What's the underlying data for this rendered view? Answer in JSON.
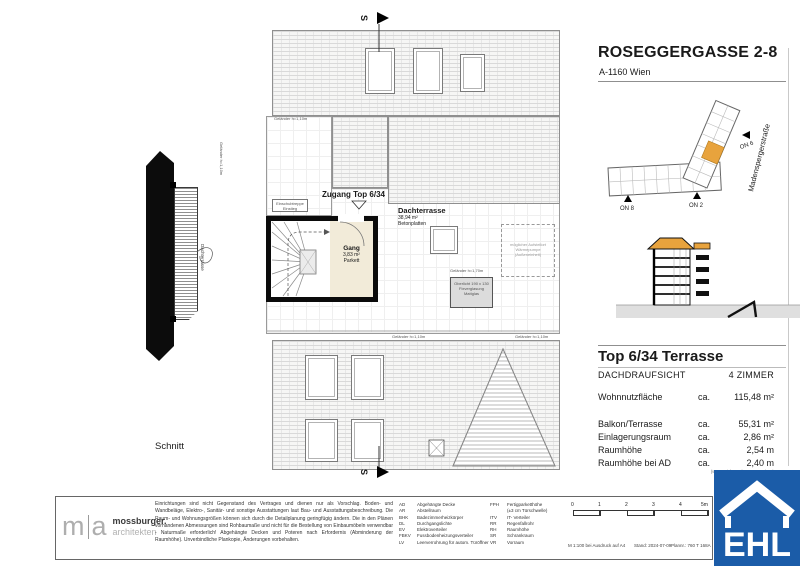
{
  "colors": {
    "accent_orange": "#E8A33D",
    "brand_blue": "#1B5CA8",
    "floor_beige": "#F2EBD9"
  },
  "header": {
    "project": "ROSEGGERGASSE 2-8",
    "address": "A-1160 Wien"
  },
  "site_plan": {
    "street": "Madenspergerstraße",
    "entrance_left": "ON 8",
    "entrance_mid": "ON 2",
    "entrance_right": "ON 6"
  },
  "unit": {
    "title": "Top 6/34 Terrasse",
    "view": "DACHDRAUFSICHT",
    "rooms": "4 ZIMMER"
  },
  "areas": {
    "rows": [
      {
        "label": "Wohnnutzfläche",
        "prefix": "ca.",
        "value": "115,48 m²"
      },
      {
        "label": "Balkon/Terrasse",
        "prefix": "ca.",
        "value": "55,31 m²"
      },
      {
        "label": "Einlagerungsraum",
        "prefix": "ca.",
        "value": "2,86 m²"
      },
      {
        "label": "Raumhöhe",
        "prefix": "ca.",
        "value": "2,54 m"
      },
      {
        "label": "Raumhöhe bei AD",
        "prefix": "ca.",
        "value": "2,40 m"
      }
    ],
    "note": "(wenn nicht anders angegeben)"
  },
  "plan": {
    "section_letter": "S",
    "zugang": "Zugang Top 6/34",
    "terrace_name": "Dachterrasse",
    "terrace_area": "38,94 m²",
    "terrace_floor": "Betonplatten",
    "gang_name": "Gang",
    "gang_area": "3,83 m²",
    "gang_floor": "Parkett",
    "railing": "Geländer h=1,10m",
    "railing_tall": "Geländer h=1,70m",
    "oberlicht_1": "Oberlicht 190 x 130",
    "oberlicht_2": "Fixverglasung",
    "oberlicht_3": "Mattglas",
    "heatpump_1": "möglicher Aufstellort",
    "heatpump_2": "Wärmepumpe (Außeneinheit)",
    "hatch_1": "Einschubtreppe",
    "hatch_2": "Einstieg",
    "section_label": "Dachterrasse",
    "schnitt": "Schnitt"
  },
  "footer": {
    "architect": {
      "mark_m": "m",
      "mark_a": "a",
      "name": "mossburger.",
      "profession": "architekten"
    },
    "disclaimer": "Einrichtungen sind nicht Gegenstand des Vertrages und dienen nur als Vorschlag. Boden- und Wandbeläge, Elektro-, Sanitär- und sonstige Ausstattungen laut Bau- und Ausstattungsbeschreibung. Die Raum- und Wohnungsgrößen können sich durch die Detailplanung geringfügig ändern. Die in den Plänen vorhandenen Abmessungen sind Rohbaumaße und nicht für die Bestellung von Einbaumöbeln verwendbar - Naturmaße erforderlich! Abgehängte Decken und Poteren nach Erfordernis (Abminderung der Raumhöhe). Unverbindliche Plankopie, Änderungen vorbehalten.",
    "legend1": [
      {
        "abbr": "AD",
        "term": "Abgehängte Decke"
      },
      {
        "abbr": "AR",
        "term": "Abstellraum"
      },
      {
        "abbr": "BHK",
        "term": "Badezimmerheizkörper"
      },
      {
        "abbr": "DL",
        "term": "Durchgangslichte"
      },
      {
        "abbr": "EV",
        "term": "Elektroverteiler"
      },
      {
        "abbr": "FBKV",
        "term": "Fussbodenheizungsverteiler"
      },
      {
        "abbr": "LV",
        "term": "Leerverrohrung für autom. Türöffner"
      }
    ],
    "legend2": [
      {
        "abbr": "FPH",
        "term": "Fertigparketthöhe",
        "term2": "(±3 cm Türschwelle)"
      },
      {
        "abbr": "ITV",
        "term": "IT- Verteiler"
      },
      {
        "abbr": "RR",
        "term": "Regenfallrohr"
      },
      {
        "abbr": "RH",
        "term": "Raumhöhe"
      },
      {
        "abbr": "SR",
        "term": "Schrankraum"
      },
      {
        "abbr": "VR",
        "term": "Vorraum"
      }
    ],
    "scale": {
      "t0": "0",
      "t1": "1",
      "t2": "2",
      "t3": "3",
      "t4": "4",
      "t5": "5m",
      "print_note": "M 1:100 bei Ausdruck auf A4",
      "stand": "Stand: 2024-07-09",
      "plan_no": "Plannr.: 760 T 168A"
    },
    "brand": "EHL"
  }
}
